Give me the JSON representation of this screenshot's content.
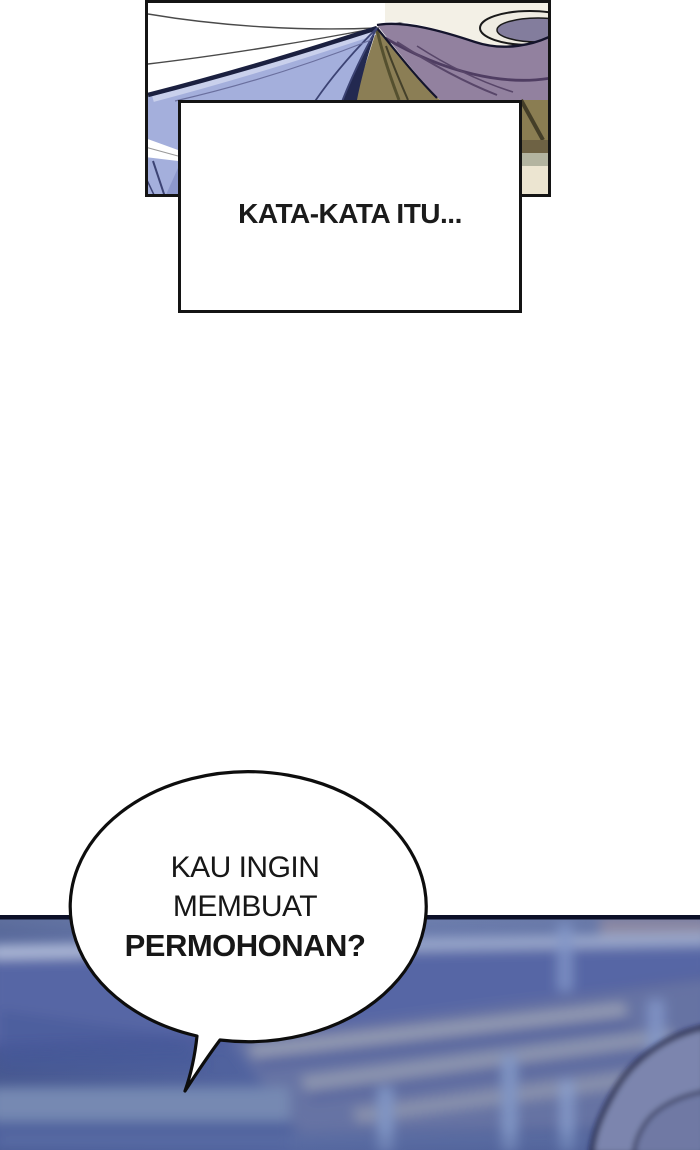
{
  "page": {
    "type": "webtoon-comic-page",
    "background": "#ffffff"
  },
  "narration": {
    "caption": "KATA-KATA ITU..."
  },
  "speech_bubble": {
    "lines": [
      "KAU INGIN",
      "MEMBUAT",
      "PERMOHONAN?"
    ],
    "bold_line_index": 2
  },
  "colors": {
    "panel_border": "#141414",
    "jacket_blue": "#a4afdc",
    "jacket_outline_navy": "#1b2040",
    "hair_olive": "#8b7e55",
    "drape_mauve": "#92819f",
    "cream": "#f3f0e6",
    "stadium_divider_navy": "#0c1028",
    "stadium_blue_mid": "#5566a2",
    "stadium_streak_light": "#9dabce",
    "railing_post_blue": "#8296c8",
    "silhouette_fill": "#7b85ae",
    "silhouette_outline": "#12163a",
    "bubble_fill": "#ffffff",
    "bubble_outline": "#0d0d0d"
  }
}
